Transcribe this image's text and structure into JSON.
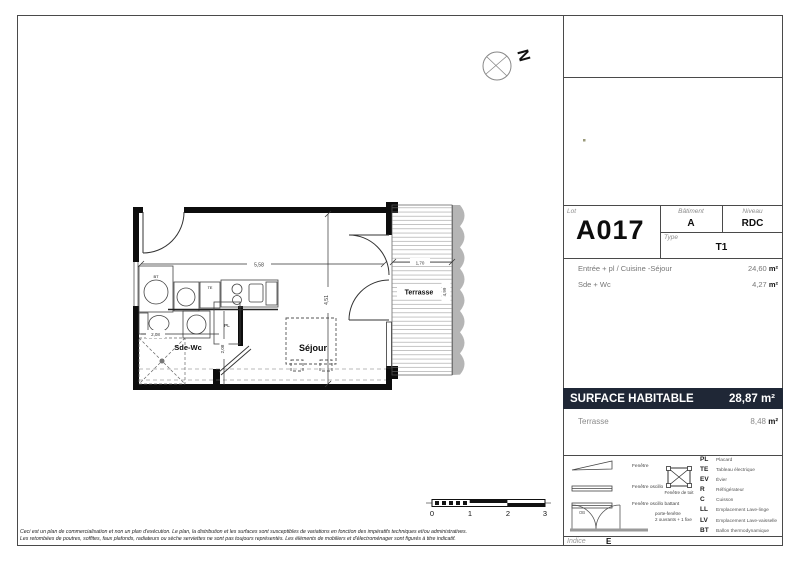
{
  "page": {
    "compass_label": "N",
    "disclaimer_line1": "Ceci est un plan de commercialisation et non un plan d'exécution. Le plan, la distribution et les surfaces sont susceptibles de variations en fonction des impératifs techniques et/ou administratives.",
    "disclaimer_line2": "Les retombées de poutres, soffites, faux plafonds, radiateurs ou sèche serviettes ne sont pas toujours représentés. Les éléments de mobiliers et d'électroménager sont figurés à titre indicatif."
  },
  "plan": {
    "labels": {
      "sejour": "Séjour",
      "sde_wc": "Sde-Wc",
      "terrasse": "Terrasse"
    },
    "fixtures": {
      "bt": "BT",
      "te": "TE",
      "pl": "PL"
    },
    "dimensions": {
      "width": "5,58",
      "height": "4,51",
      "sde_width": "2,08",
      "sde_height": "2,08",
      "terrasse_width": "1,70",
      "terrasse_height": "4,99"
    }
  },
  "scale_bar": {
    "labels": [
      "0",
      "1",
      "2",
      "3"
    ]
  },
  "title_block": {
    "lot_label": "Lot",
    "lot": "A017",
    "batiment_label": "Bâtiment",
    "batiment": "A",
    "niveau_label": "Niveau",
    "niveau": "RDC",
    "type_label": "Type",
    "type": "T1"
  },
  "areas": {
    "rows": [
      {
        "label": "Entrée + pl / Cuisine -Séjour",
        "value": "24,60",
        "unit": "m²"
      },
      {
        "label": "Sde + Wc",
        "value": "4,27",
        "unit": "m²"
      }
    ],
    "surface_habitable_label": "SURFACE HABITABLE",
    "surface_habitable_value": "28,87",
    "surface_habitable_unit": "m²",
    "terrasse_label": "Terrasse",
    "terrasse_value": "8,48",
    "terrasse_unit": "m²"
  },
  "legend": {
    "window_items": [
      {
        "label": "Fenêtre"
      },
      {
        "label": "Fenêtre oscillo"
      },
      {
        "label": "Fenêtre oscillo battant",
        "symbol_tag": "OB"
      }
    ],
    "roof_window_label": "Fenêtre de toit",
    "door_label_line1": "porte-fenêtre",
    "door_label_line2": "2 ouvrants + 1 fixe",
    "abbreviations": [
      {
        "abbr": "PL",
        "label": "Placard"
      },
      {
        "abbr": "TE",
        "label": "Tableau électrique"
      },
      {
        "abbr": "EV",
        "label": "Évier"
      },
      {
        "abbr": "R",
        "label": "Réfrigérateur"
      },
      {
        "abbr": "C",
        "label": "Cuisson"
      },
      {
        "abbr": "LL",
        "label": "Emplacement Lave-linge"
      },
      {
        "abbr": "LV",
        "label": "Emplacement Lave-vaisselle"
      },
      {
        "abbr": "BT",
        "label": "Ballon thermodynamique"
      }
    ]
  },
  "footer": {
    "indice_label": "Indice",
    "indice_value": "E"
  },
  "colors": {
    "accent_navy": "#1f2736"
  }
}
